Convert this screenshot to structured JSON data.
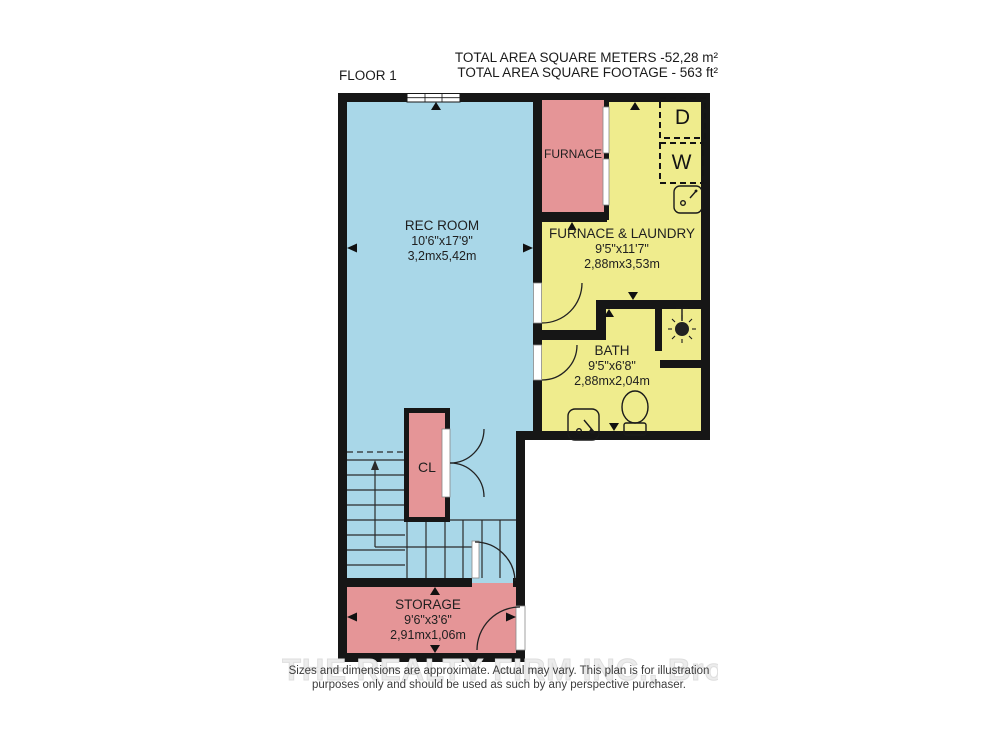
{
  "header": {
    "area_meters": "TOTAL AREA SQUARE METERS -52,28 m²",
    "area_feet": "TOTAL AREA SQUARE FOOTAGE - 563 ft²",
    "floor": "FLOOR 1"
  },
  "rooms": {
    "rec_room": {
      "name": "REC ROOM",
      "size_imperial": "10'6\"x17'9\"",
      "size_metric": "3,2mx5,42m",
      "color": "#a9d7e8"
    },
    "furnace_laundry": {
      "name": "FURNACE & LAUNDRY",
      "size_imperial": "9'5\"x11'7\"",
      "size_metric": "2,88mx3,53m",
      "color": "#efec8d"
    },
    "bath": {
      "name": "BATH",
      "size_imperial": "9'5\"x6'8\"",
      "size_metric": "2,88mx2,04m",
      "color": "#efec8d"
    },
    "storage": {
      "name": "STORAGE",
      "size_imperial": "9'6\"x3'6\"",
      "size_metric": "2,91mx1,06m",
      "color": "#e59597"
    }
  },
  "labels": {
    "furnace": "FURNACE",
    "closet": "CL",
    "dryer": "D",
    "washer": "W"
  },
  "fixtures": [
    "stairs-icon",
    "window-icon",
    "laundry-sink-icon",
    "bath-sink-icon",
    "toilet-icon",
    "shower-head-icon",
    "door-swing-icon"
  ],
  "footer": {
    "disclaimer_line1": "Sizes and dimensions are approximate. Actual may vary. This plan is for illustration",
    "disclaimer_line2": "purposes only and should be used as such by any perspective purchaser.",
    "watermark": "THE REALTY FIRM INC., Brokerage"
  },
  "colors": {
    "wall": "#161616",
    "rec_room": "#a9d7e8",
    "laundry_bath": "#efec8d",
    "storage_furnace_closet": "#e59597",
    "background": "#ffffff"
  }
}
